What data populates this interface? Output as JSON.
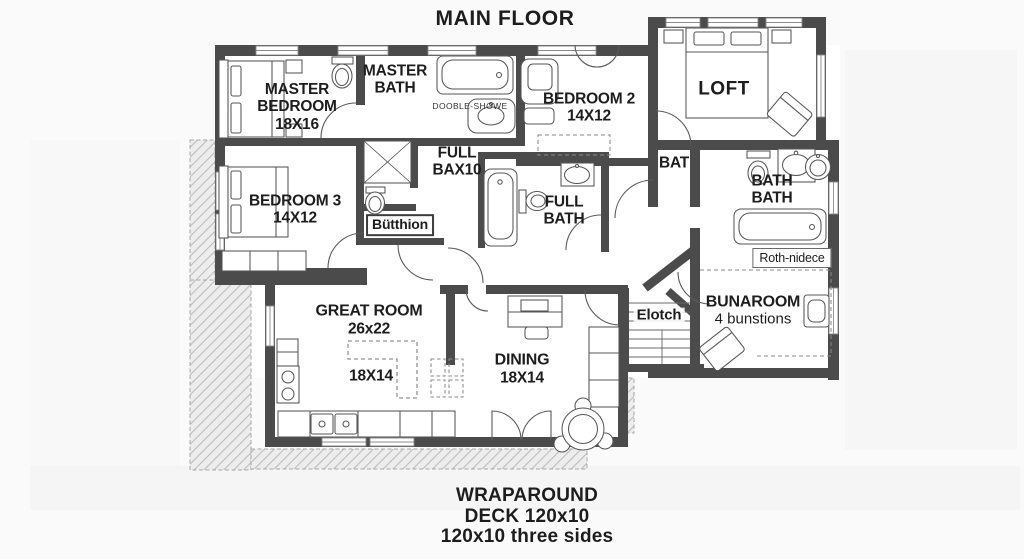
{
  "title": "MAIN FLOOR",
  "colors": {
    "wall": "#4b4b4b",
    "text": "#1d1d1d",
    "deck_fill": "#ededed",
    "deck_hatch": "#bdbdbd"
  },
  "rooms": {
    "master_bedroom": {
      "label": "MASTER BEDROOM",
      "size": "18X16"
    },
    "master_bath": {
      "label": "MASTER BATH"
    },
    "shower_note": {
      "label": "DOOBLE-SHOWE"
    },
    "bedroom2": {
      "label": "BEDROOM 2",
      "size": "14X12"
    },
    "loft": {
      "label": "LOFT"
    },
    "bedroom3": {
      "label": "BEDROOM 3",
      "size": "14X12"
    },
    "full_bax": {
      "label": "FULL BAX10"
    },
    "closet1": {
      "label": "Bütthion"
    },
    "full_bath": {
      "label": "FULL BATH"
    },
    "bat": {
      "label": "BAT"
    },
    "bath_bath": {
      "label": "BATH BATH"
    },
    "closet2": {
      "label": "Roth-nidece"
    },
    "bunaroom": {
      "label": "BUNAROOM",
      "size": "4 bunstions"
    },
    "stairs": {
      "label": "Elotch"
    },
    "great_room": {
      "label": "GREAT ROOM",
      "size": "26x22"
    },
    "island": {
      "size": "18X14"
    },
    "dining": {
      "label": "DINING",
      "size": "18X14"
    }
  },
  "footer": {
    "line1": "WRAPAROUND",
    "line2": "DECK 120x10",
    "line3": "120x10 three sides"
  }
}
